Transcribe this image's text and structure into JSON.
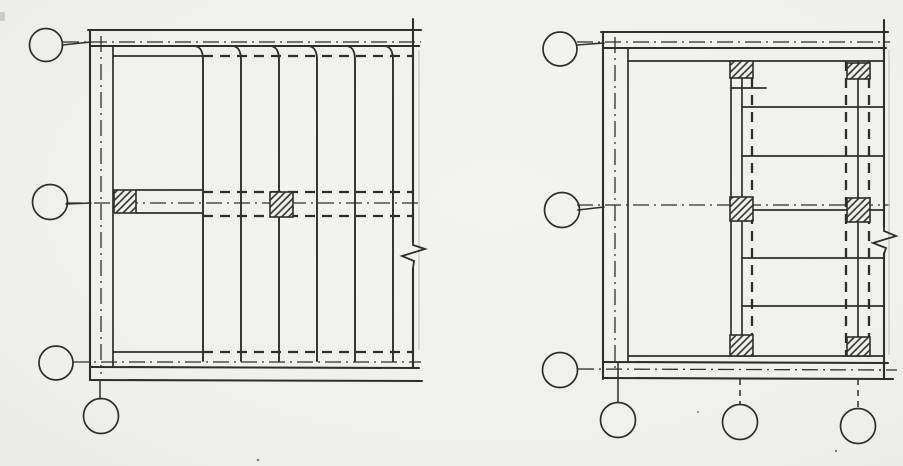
{
  "page": {
    "width": 903,
    "height": 466,
    "colors": {
      "paper": "#f1f1ef",
      "ink": "#2f2e2b",
      "ghost": "#c7c7c1",
      "speck": "#83837d"
    }
  },
  "plans": [
    {
      "name": "framing-plan-left",
      "elements": [
        {
          "t": "line",
          "n": "top-band-outer-line",
          "x1": 88,
          "y1": 30,
          "x2": 421,
          "y2": 30,
          "s": "wall"
        },
        {
          "t": "line",
          "n": "top-band-inner-line",
          "x1": 91,
          "y1": 46,
          "x2": 419,
          "y2": 46,
          "s": "wall"
        },
        {
          "t": "line",
          "n": "grid-axis-a",
          "x1": 63,
          "y1": 42,
          "x2": 421,
          "y2": 42,
          "s": "axis"
        },
        {
          "t": "line",
          "n": "slab-edge-top-solid",
          "x1": 113,
          "y1": 56,
          "x2": 203,
          "y2": 56,
          "s": "inner"
        },
        {
          "t": "line",
          "n": "slab-edge-top-hidden",
          "x1": 203,
          "y1": 56,
          "x2": 413,
          "y2": 56,
          "s": "hidden"
        },
        {
          "t": "line",
          "n": "left-wall-outer-line",
          "x1": 90,
          "y1": 30,
          "x2": 90,
          "y2": 380,
          "s": "wall"
        },
        {
          "t": "line",
          "n": "left-wall-inner-line",
          "x1": 113,
          "y1": 46,
          "x2": 113,
          "y2": 367,
          "s": "inner"
        },
        {
          "t": "line",
          "n": "wall-axis-vertical",
          "x1": 101,
          "y1": 36,
          "x2": 101,
          "y2": 374,
          "s": "axis"
        },
        {
          "t": "line",
          "n": "grid-axis-b",
          "x1": 66,
          "y1": 203,
          "x2": 421,
          "y2": 203,
          "s": "axis"
        },
        {
          "t": "line",
          "n": "grid-axis-c",
          "x1": 73,
          "y1": 362,
          "x2": 421,
          "y2": 362,
          "s": "axis"
        },
        {
          "t": "line",
          "n": "slab-edge-bottom-solid",
          "x1": 113,
          "y1": 352,
          "x2": 203,
          "y2": 352,
          "s": "inner"
        },
        {
          "t": "line",
          "n": "slab-edge-bottom-hidden",
          "x1": 203,
          "y1": 352,
          "x2": 413,
          "y2": 352,
          "s": "hidden"
        },
        {
          "t": "line",
          "n": "bottom-band-inner-line",
          "x1": 90,
          "y1": 367,
          "x2": 419,
          "y2": 368,
          "s": "wall"
        },
        {
          "t": "line",
          "n": "bottom-band-outer-line",
          "x1": 90,
          "y1": 380,
          "x2": 422,
          "y2": 381,
          "s": "wall"
        },
        {
          "t": "line",
          "n": "right-edge-upper",
          "x1": 413,
          "y1": 19,
          "x2": 413,
          "y2": 242,
          "s": "wall"
        },
        {
          "t": "line",
          "n": "right-edge-lower",
          "x1": 413,
          "y1": 268,
          "x2": 413,
          "y2": 368,
          "s": "wall"
        },
        {
          "t": "line",
          "n": "right-edge-ghost",
          "x1": 419,
          "y1": 50,
          "x2": 419,
          "y2": 350,
          "s": "ghost"
        },
        {
          "t": "line",
          "n": "beam-top-solid",
          "x1": 136,
          "y1": 190,
          "x2": 203,
          "y2": 190,
          "s": "inner"
        },
        {
          "t": "line",
          "n": "beam-bottom-solid",
          "x1": 136,
          "y1": 213,
          "x2": 203,
          "y2": 213,
          "s": "inner"
        },
        {
          "t": "line",
          "n": "beam-top-hidden",
          "x1": 203,
          "y1": 192,
          "x2": 413,
          "y2": 192,
          "s": "hidden"
        },
        {
          "t": "line",
          "n": "beam-bottom-hidden",
          "x1": 203,
          "y1": 216,
          "x2": 413,
          "y2": 216,
          "s": "hidden"
        },
        {
          "t": "joist",
          "n": "joist-1",
          "x": 203,
          "y1": 46,
          "y2": 361
        },
        {
          "t": "joist",
          "n": "joist-2",
          "x": 241,
          "y1": 46,
          "y2": 361
        },
        {
          "t": "joist",
          "n": "joist-3",
          "x": 279,
          "y1": 46,
          "y2": 361
        },
        {
          "t": "joist",
          "n": "joist-4",
          "x": 317,
          "y1": 46,
          "y2": 361
        },
        {
          "t": "joist",
          "n": "joist-5",
          "x": 355,
          "y1": 46,
          "y2": 361
        },
        {
          "t": "joist",
          "n": "joist-6",
          "x": 393,
          "y1": 46,
          "y2": 361
        },
        {
          "t": "rect",
          "n": "column-hatched-a",
          "x": 114,
          "y": 190,
          "w": 22,
          "h": 23
        },
        {
          "t": "rect",
          "n": "column-hatched-b",
          "x": 270,
          "y": 192,
          "w": 23,
          "h": 25
        },
        {
          "t": "line",
          "n": "leader-grid-a",
          "x1": 62,
          "y1": 45,
          "x2": 91,
          "y2": 42,
          "s": "leader"
        },
        {
          "t": "line",
          "n": "leader-grid-b",
          "x1": 66,
          "y1": 204,
          "x2": 91,
          "y2": 203,
          "s": "leader"
        },
        {
          "t": "line",
          "n": "leader-grid-d",
          "x1": 100,
          "y1": 380,
          "x2": 100,
          "y2": 399,
          "s": "leader"
        },
        {
          "t": "circle",
          "n": "grid-bubble-a",
          "cx": 46,
          "cy": 45,
          "r": 16.5
        },
        {
          "t": "circle",
          "n": "grid-bubble-b",
          "cx": 50,
          "cy": 202,
          "r": 17.5
        },
        {
          "t": "circle",
          "n": "grid-bubble-c",
          "cx": 56,
          "cy": 363,
          "r": 17
        },
        {
          "t": "circle",
          "n": "grid-bubble-d",
          "cx": 101,
          "cy": 416,
          "r": 17.5
        },
        {
          "t": "path",
          "n": "break-symbol",
          "d": "M413,240 L413,245 L425,249 L402,256 L414,261 L413,268",
          "s": "break"
        }
      ]
    },
    {
      "name": "framing-plan-right",
      "elements": [
        {
          "t": "line",
          "n": "top-band-outer-line",
          "x1": 601,
          "y1": 32,
          "x2": 888,
          "y2": 32,
          "s": "wall"
        },
        {
          "t": "line",
          "n": "top-band-inner-line",
          "x1": 603,
          "y1": 48,
          "x2": 886,
          "y2": 48,
          "s": "wall"
        },
        {
          "t": "line",
          "n": "grid-axis-d",
          "x1": 577,
          "y1": 42,
          "x2": 890,
          "y2": 42,
          "s": "axis"
        },
        {
          "t": "line",
          "n": "slab-edge-top",
          "x1": 628,
          "y1": 61,
          "x2": 884,
          "y2": 61,
          "s": "inner"
        },
        {
          "t": "line",
          "n": "left-wall-outer-line",
          "x1": 603,
          "y1": 32,
          "x2": 603,
          "y2": 379,
          "s": "wall"
        },
        {
          "t": "line",
          "n": "left-wall-inner-line",
          "x1": 628,
          "y1": 48,
          "x2": 628,
          "y2": 362,
          "s": "inner"
        },
        {
          "t": "line",
          "n": "wall-axis-vertical",
          "x1": 615,
          "y1": 37,
          "x2": 615,
          "y2": 373,
          "s": "axis"
        },
        {
          "t": "line",
          "n": "grid-axis-e",
          "x1": 577,
          "y1": 205,
          "x2": 890,
          "y2": 205,
          "s": "axis"
        },
        {
          "t": "line",
          "n": "grid-axis-f",
          "x1": 578,
          "y1": 369,
          "x2": 897,
          "y2": 370,
          "s": "axis"
        },
        {
          "t": "line",
          "n": "slab-edge-bottom",
          "x1": 628,
          "y1": 356,
          "x2": 884,
          "y2": 356,
          "s": "inner"
        },
        {
          "t": "line",
          "n": "bottom-band-inner-line",
          "x1": 603,
          "y1": 362,
          "x2": 888,
          "y2": 363,
          "s": "wall"
        },
        {
          "t": "line",
          "n": "bottom-band-outer-line",
          "x1": 603,
          "y1": 378,
          "x2": 893,
          "y2": 379,
          "s": "wall"
        },
        {
          "t": "line",
          "n": "right-edge-upper",
          "x1": 884,
          "y1": 20,
          "x2": 884,
          "y2": 227,
          "s": "wall"
        },
        {
          "t": "line",
          "n": "right-edge-lower",
          "x1": 884,
          "y1": 253,
          "x2": 884,
          "y2": 378,
          "s": "wall"
        },
        {
          "t": "line",
          "n": "right-edge-ghost",
          "x1": 889,
          "y1": 50,
          "x2": 889,
          "y2": 355,
          "s": "ghost"
        },
        {
          "t": "line",
          "n": "mid-beam-edge-1",
          "x1": 731,
          "y1": 61,
          "x2": 731,
          "y2": 356,
          "s": "inner"
        },
        {
          "t": "line",
          "n": "mid-beam-edge-2",
          "x1": 742,
          "y1": 61,
          "x2": 742,
          "y2": 356,
          "s": "inner"
        },
        {
          "t": "line",
          "n": "mid-beam-hidden",
          "x1": 752,
          "y1": 61,
          "x2": 752,
          "y2": 356,
          "s": "hidden"
        },
        {
          "t": "line",
          "n": "right-beam-hidden-1",
          "x1": 846,
          "y1": 61,
          "x2": 846,
          "y2": 356,
          "s": "hidden"
        },
        {
          "t": "line",
          "n": "right-beam-edge",
          "x1": 858,
          "y1": 61,
          "x2": 858,
          "y2": 356,
          "s": "inner"
        },
        {
          "t": "line",
          "n": "right-beam-hidden-2",
          "x1": 869,
          "y1": 61,
          "x2": 869,
          "y2": 356,
          "s": "hidden"
        },
        {
          "t": "line",
          "n": "joist-stub",
          "x1": 732,
          "y1": 88,
          "x2": 766,
          "y2": 88,
          "s": "inner"
        },
        {
          "t": "line",
          "n": "joist-row-1",
          "x1": 742,
          "y1": 107,
          "x2": 884,
          "y2": 107,
          "s": "inner"
        },
        {
          "t": "line",
          "n": "joist-row-2",
          "x1": 742,
          "y1": 156,
          "x2": 884,
          "y2": 156,
          "s": "inner"
        },
        {
          "t": "line",
          "n": "joist-row-3",
          "x1": 742,
          "y1": 210,
          "x2": 884,
          "y2": 210,
          "s": "inner"
        },
        {
          "t": "line",
          "n": "joist-row-4",
          "x1": 742,
          "y1": 258,
          "x2": 884,
          "y2": 258,
          "s": "inner"
        },
        {
          "t": "line",
          "n": "joist-row-5",
          "x1": 742,
          "y1": 306,
          "x2": 884,
          "y2": 306,
          "s": "inner"
        },
        {
          "t": "rect",
          "n": "column-hatched-mid-top",
          "x": 730,
          "y": 61,
          "w": 23,
          "h": 17
        },
        {
          "t": "rect",
          "n": "column-hatched-right-top",
          "x": 847,
          "y": 63,
          "w": 23,
          "h": 16
        },
        {
          "t": "rect",
          "n": "column-hatched-mid-center",
          "x": 730,
          "y": 197,
          "w": 23,
          "h": 24
        },
        {
          "t": "rect",
          "n": "column-hatched-right-center",
          "x": 847,
          "y": 198,
          "w": 23,
          "h": 24
        },
        {
          "t": "rect",
          "n": "column-hatched-mid-bottom",
          "x": 730,
          "y": 335,
          "w": 23,
          "h": 21
        },
        {
          "t": "rect",
          "n": "column-hatched-right-bottom",
          "x": 847,
          "y": 337,
          "w": 23,
          "h": 19
        },
        {
          "t": "line",
          "n": "leader-grid-d",
          "x1": 577,
          "y1": 45,
          "x2": 604,
          "y2": 43,
          "s": "leader"
        },
        {
          "t": "line",
          "n": "leader-grid-e",
          "x1": 578,
          "y1": 210,
          "x2": 604,
          "y2": 207,
          "s": "leader"
        },
        {
          "t": "line",
          "n": "leader-grid-g",
          "x1": 618,
          "y1": 363,
          "x2": 618,
          "y2": 402,
          "s": "leader"
        },
        {
          "t": "line",
          "n": "leader-grid-h",
          "x1": 740,
          "y1": 379,
          "x2": 740,
          "y2": 404,
          "s": "leaderdash"
        },
        {
          "t": "line",
          "n": "leader-grid-i",
          "x1": 858,
          "y1": 379,
          "x2": 858,
          "y2": 407,
          "s": "leaderdash"
        },
        {
          "t": "circle",
          "n": "grid-bubble-d",
          "cx": 560,
          "cy": 49,
          "r": 17
        },
        {
          "t": "circle",
          "n": "grid-bubble-e",
          "cx": 562,
          "cy": 210,
          "r": 17.5
        },
        {
          "t": "circle",
          "n": "grid-bubble-f",
          "cx": 560,
          "cy": 370,
          "r": 17.5
        },
        {
          "t": "circle",
          "n": "grid-bubble-g",
          "cx": 618,
          "cy": 420,
          "r": 17.5
        },
        {
          "t": "circle",
          "n": "grid-bubble-h",
          "cx": 740,
          "cy": 422,
          "r": 17.5
        },
        {
          "t": "circle",
          "n": "grid-bubble-i",
          "cx": 858,
          "cy": 426,
          "r": 17.5
        },
        {
          "t": "path",
          "n": "break-symbol",
          "d": "M884,225 L884,231 L896,236 L873,243 L886,248 L884,254",
          "s": "break"
        }
      ]
    }
  ],
  "artifacts": {
    "specks": [
      {
        "n": "paper-speck-1",
        "x": 258,
        "y": 460,
        "r": 1.3
      },
      {
        "n": "paper-speck-2",
        "x": 698,
        "y": 412,
        "r": 1.0
      },
      {
        "n": "paper-speck-3",
        "x": 836,
        "y": 451,
        "r": 1.2
      }
    ],
    "smudge": {
      "n": "scan-smudge-left-edge",
      "x": 0,
      "y": 12,
      "w": 5,
      "h": 9
    }
  }
}
